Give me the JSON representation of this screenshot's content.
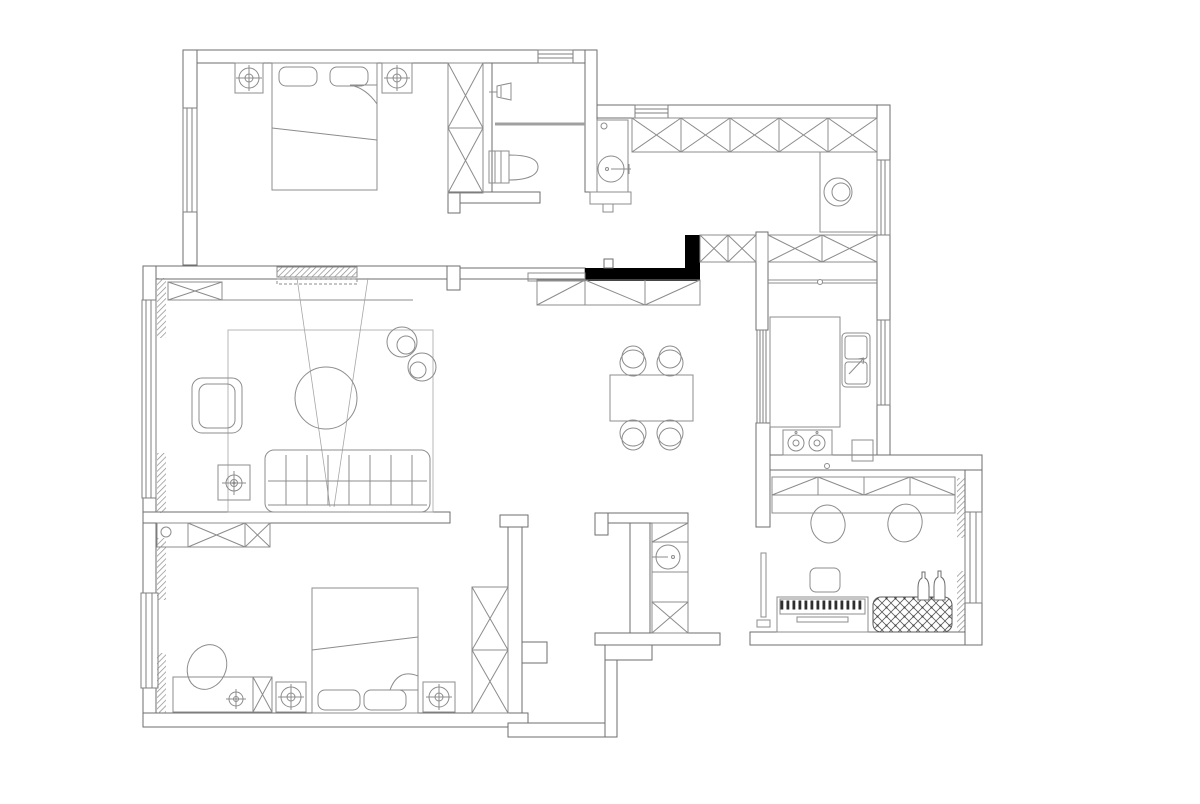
{
  "meta": {
    "title": "Apartment Floor Plan",
    "drawing_type": "architectural-floor-plan",
    "canvas_width": 1200,
    "canvas_height": 804
  },
  "colors": {
    "bg": "#ffffff",
    "wall": "#6e6e6e",
    "furniture": "#8c8c8c",
    "light": "#a6a6a6",
    "black": "#000000"
  },
  "rooms": [
    {
      "id": "master-bedroom",
      "fixtures": [
        "double-bed",
        "pillow",
        "pillow",
        "nightstand",
        "ceiling-lamp",
        "nightstand",
        "ceiling-lamp",
        "wardrobe",
        "bay-window"
      ]
    },
    {
      "id": "master-bathroom",
      "fixtures": [
        "shower-head",
        "shower-partition",
        "toilet",
        "window"
      ]
    },
    {
      "id": "entry-hall",
      "fixtures": [
        "vanity-basin",
        "storage-cabinet-row",
        "shoe-sideboard",
        "black-feature-wall",
        "window"
      ]
    },
    {
      "id": "utility-corridor",
      "fixtures": [
        "storage-cabinet-row",
        "washing-machine",
        "window"
      ]
    },
    {
      "id": "kitchen",
      "fixtures": [
        "counter",
        "double-sink",
        "faucet",
        "cooktop",
        "sliding-glass-door",
        "window",
        "corner-cabinet"
      ]
    },
    {
      "id": "dining-area",
      "fixtures": [
        "dining-table",
        "chair",
        "chair",
        "chair",
        "chair"
      ]
    },
    {
      "id": "living-room",
      "fixtures": [
        "tv-wall",
        "media-cabinet",
        "sofa",
        "armchair",
        "coffee-table",
        "side-table",
        "floor-lamp",
        "plant",
        "plant",
        "rug",
        "bay-window",
        "curtains"
      ]
    },
    {
      "id": "second-bedroom",
      "fixtures": [
        "double-bed",
        "pillow",
        "pillow",
        "nightstand",
        "table-lamp",
        "nightstand",
        "table-lamp",
        "desk",
        "desk-lamp",
        "chair",
        "wardrobe",
        "overhead-cabinet",
        "bay-window",
        "curtains"
      ]
    },
    {
      "id": "study",
      "fixtures": [
        "desk",
        "overhead-cabinet",
        "chair",
        "chair",
        "piano",
        "piano-bench",
        "chesterfield-sofa",
        "decor-bottles",
        "wall-tv",
        "bay-window",
        "curtains"
      ]
    },
    {
      "id": "powder-room",
      "fixtures": [
        "wash-basin",
        "faucet",
        "storage-cabinet"
      ]
    }
  ]
}
